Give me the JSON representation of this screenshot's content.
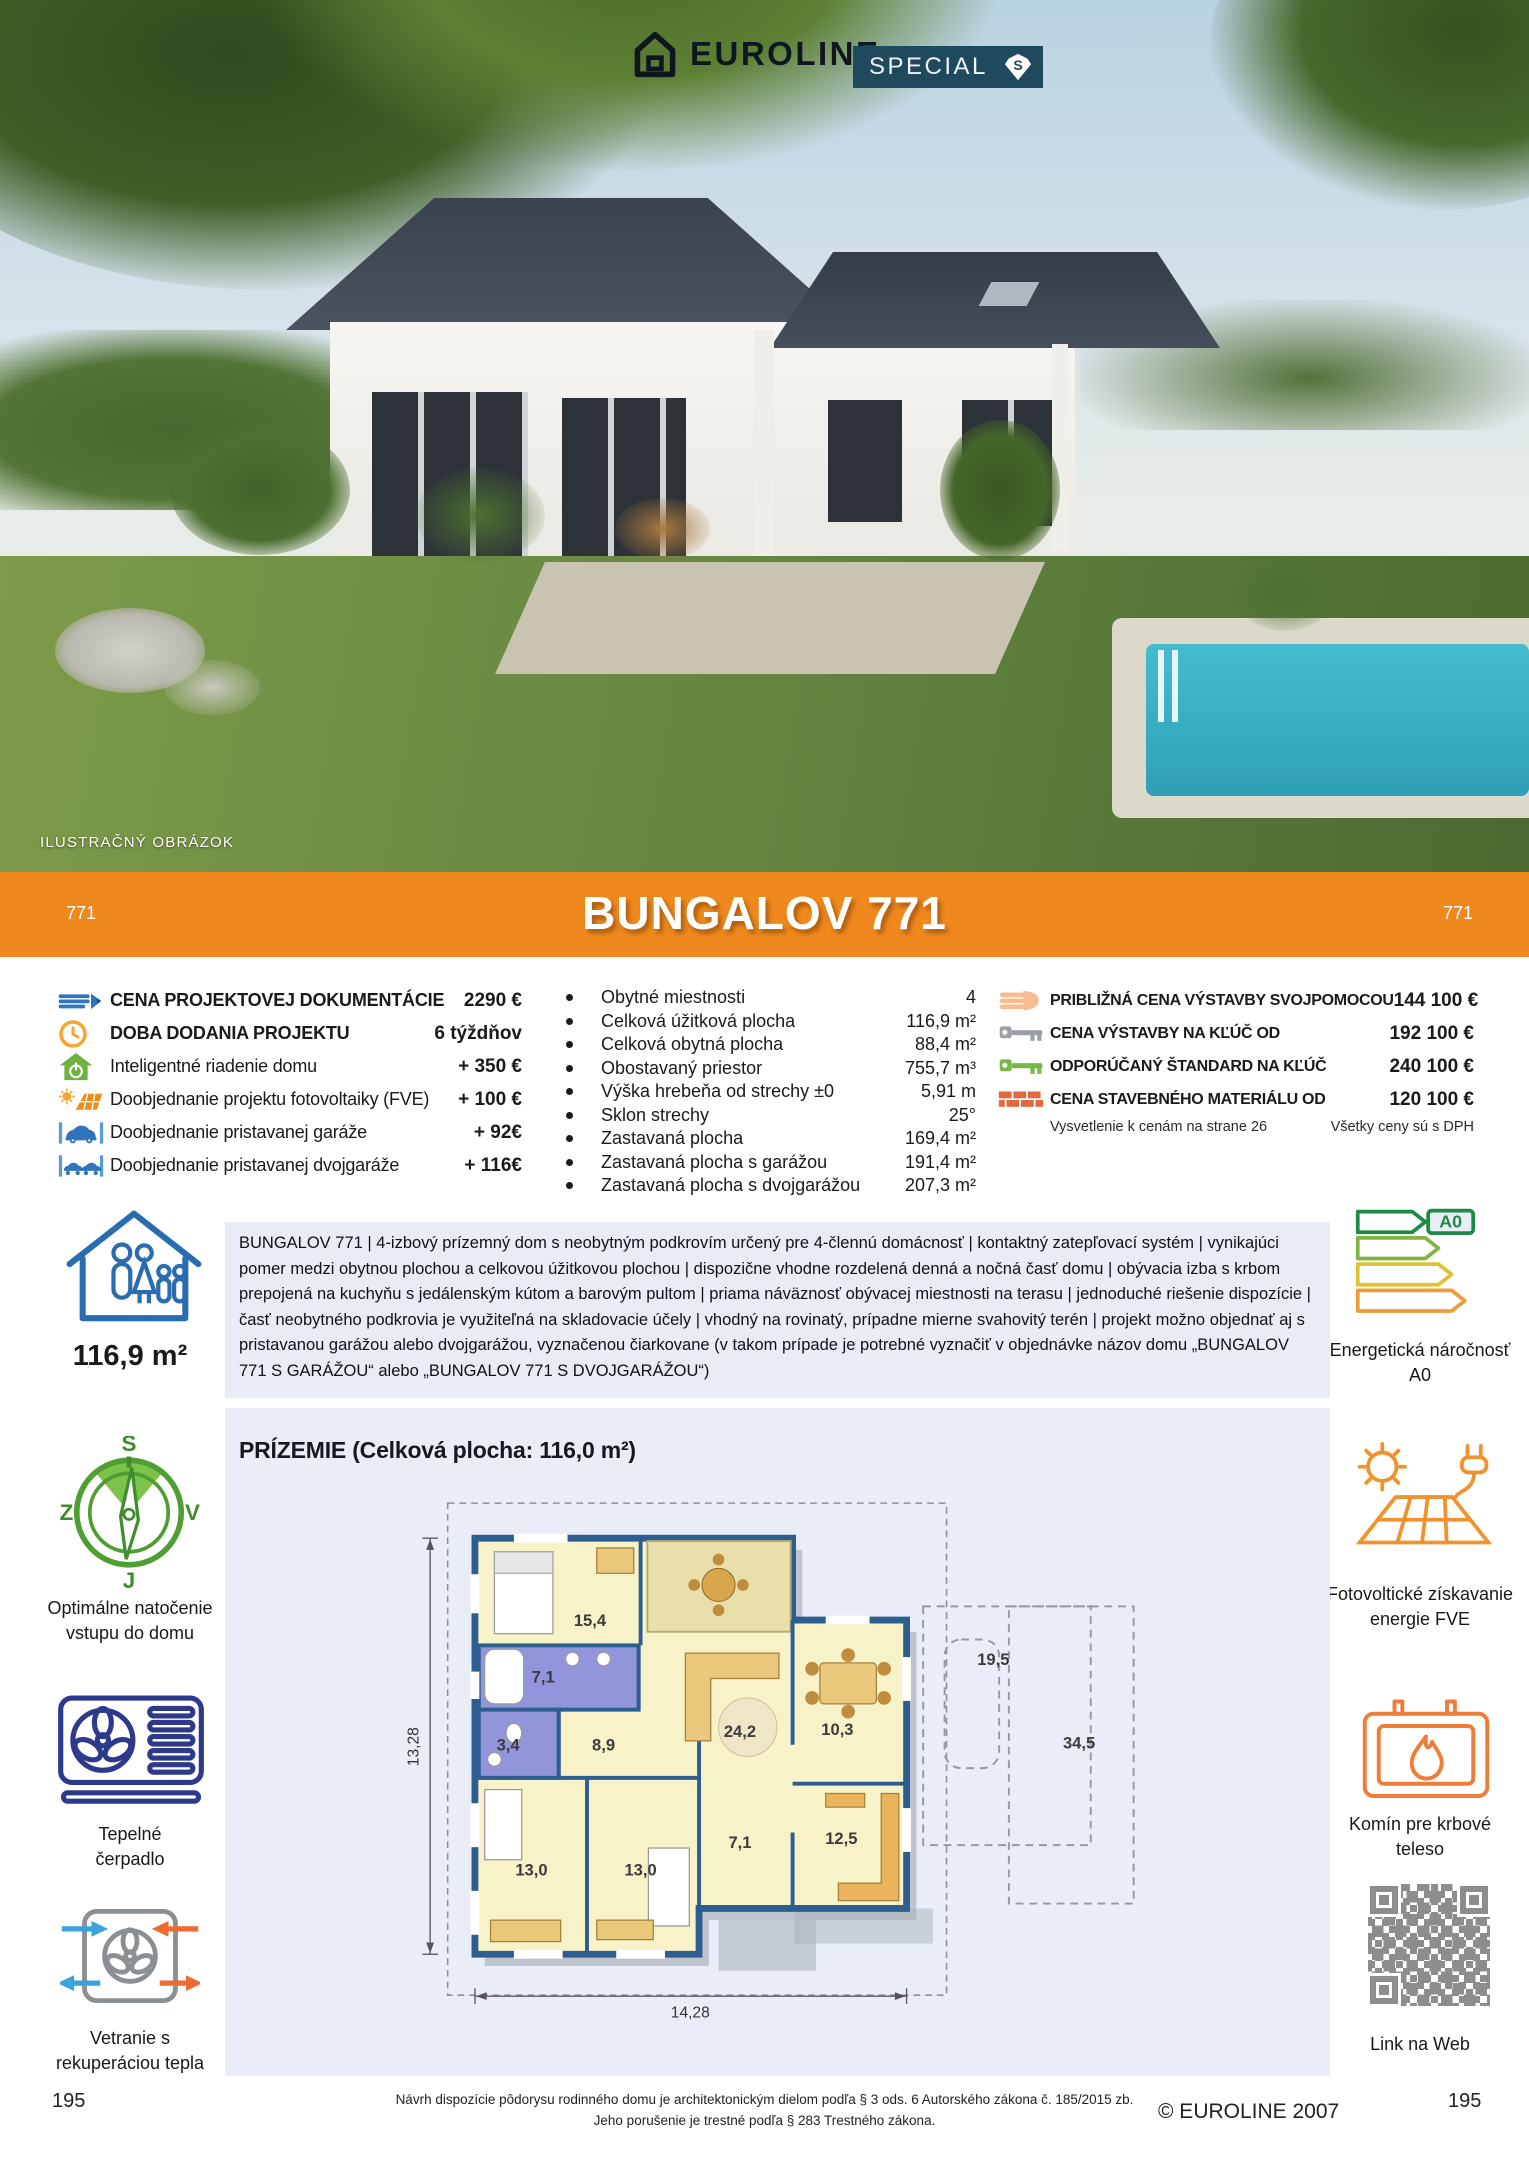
{
  "header": {
    "brand": "EUROLINE",
    "special_label": "SPECIAL",
    "special_badge_letter": "S",
    "photo_caption": "ILUSTRAČNÝ OBRÁZOK"
  },
  "banner": {
    "title": "BUNGALOV 771",
    "left_number": "771",
    "right_number": "771",
    "color": "#f0891d"
  },
  "specs_left": {
    "items": [
      {
        "icon": "pencil-icon",
        "label": "CENA PROJEKTOVEJ DOKUMENTÁCIE",
        "value": "2290 €"
      },
      {
        "icon": "clock-icon",
        "label": "DOBA DODANIA PROJEKTU",
        "value": "6 týždňov"
      },
      {
        "icon": "smart-home-icon",
        "label": "Inteligentné riadenie domu",
        "value": "+ 350 €"
      },
      {
        "icon": "solar-project-icon",
        "label": "Doobjednanie projektu fotovoltaiky (FVE)",
        "value": "+ 100 €"
      },
      {
        "icon": "garage-icon",
        "label": "Doobjednanie pristavanej garáže",
        "value": "+ 92€"
      },
      {
        "icon": "double-garage-icon",
        "label": "Doobjednanie pristavanej dvojgaráže",
        "value": "+ 116€"
      }
    ]
  },
  "specs_middle": {
    "items": [
      {
        "label": "Obytné miestnosti",
        "value": "4"
      },
      {
        "label": "Celková úžitková plocha",
        "value": "116,9 m²"
      },
      {
        "label": "Celková obytná plocha",
        "value": "88,4 m²"
      },
      {
        "label": "Obostavaný priestor",
        "value": "755,7 m³"
      },
      {
        "label": "Výška hrebeňa od strechy ±0",
        "value": "5,91 m"
      },
      {
        "label": "Sklon strechy",
        "value": "25°"
      },
      {
        "label": "Zastavaná plocha",
        "value": "169,4 m²"
      },
      {
        "label": "Zastavaná plocha s garážou",
        "value": "191,4 m²"
      },
      {
        "label": "Zastavaná plocha s dvojgarážou",
        "value": "207,3 m²"
      }
    ]
  },
  "specs_right": {
    "items": [
      {
        "icon": "hand-icon",
        "label": "PRIBLIŽNÁ CENA VÝSTAVBY SVOJPOMOCOU",
        "value": "144 100 €"
      },
      {
        "icon": "key-gray-icon",
        "label": "CENA VÝSTAVBY NA KĽÚČ OD",
        "value": "192 100 €"
      },
      {
        "icon": "key-green-icon",
        "label": "ODPORÚČANÝ ŠTANDARD NA KĽÚČ",
        "value": "240 100 €"
      },
      {
        "icon": "bricks-icon",
        "label": "CENA STAVEBNÉHO MATERIÁLU OD",
        "value": "120 100 €"
      }
    ],
    "note_left": "Vysvetlenie k cenám na strane 26",
    "note_right": "Všetky ceny sú s DPH"
  },
  "description": "BUNGALOV 771 | 4-izbový prízemný dom s neobytným podkrovím určený pre 4-člennú domácnosť | kontaktný zatepľovací systém | vynikajúci pomer medzi obytnou plochou a celkovou úžitkovou plochou | dispozične vhodne rozdelená denná a nočná časť domu | obývacia izba s krbom prepojená na kuchyňu s jedálenským kútom a barovým pultom | priama náväznosť obývacej miestnosti na terasu | jednoduché riešenie dispozície | časť neobytného podkrovia je využiteľná na skladovacie účely | vhodný na rovinatý, prípadne mierne svahovitý terén | projekt možno objednať aj s pristavanou garážou alebo dvojgarážou, vyznačenou čiarkovane (v takom prípade je potrebné vyznačiť v objednávke názov domu „BUNGALOV 771 S GARÁŽOU“ alebo „BUNGALOV 771 S DVOJGARÁŽOU“)",
  "sidebar_left": {
    "area_value": "116,9 m²",
    "compass": {
      "n": "S",
      "e": "V",
      "s": "J",
      "w": "Z",
      "caption": "Optimálne natočenie vstupu do domu"
    },
    "heat_pump_caption": "Tepelné čerpadlo",
    "ventilation_caption": "Vetranie s rekuperáciou tepla"
  },
  "sidebar_right": {
    "energy_badge": "A0",
    "energy_caption": "Energetická náročnosť A0",
    "fve_caption": "Fotovoltické získavanie energie FVE",
    "chimney_caption": "Komín pre krbové teleso",
    "qr_caption": "Link na Web"
  },
  "floorplan": {
    "title": "PRÍZEMIE (Celková plocha: 116,0 m²)",
    "width_dim": "14,28",
    "height_dim": "13,28",
    "room_areas": [
      "15,4",
      "7,1",
      "3,4",
      "8,9",
      "24,2",
      "10,3",
      "19,5",
      "34,5",
      "13,0",
      "13,0",
      "7,1",
      "12,5"
    ]
  },
  "footer": {
    "note_line1": "Návrh dispozície pôdorysu rodinného domu je architektonickým dielom podľa § 3 ods. 6 Autorského zákona č. 185/2015 zb.",
    "note_line2": "Jeho porušenie je trestné podľa § 283 Trestného zákona.",
    "copyright": "© EUROLINE 2007",
    "page_number_left": "195",
    "page_number_right": "195"
  }
}
